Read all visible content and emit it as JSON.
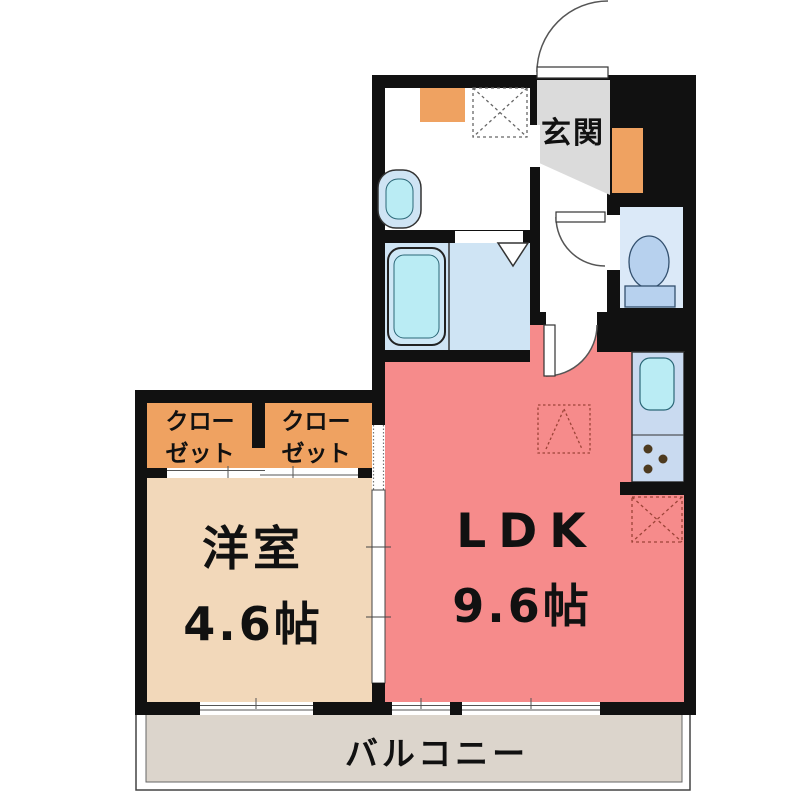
{
  "colors": {
    "wall": "#111111",
    "ldk": "#f68b8b",
    "bedroom": "#f2d8ba",
    "closet": "#efa261",
    "shoe_cabinet": "#efa261",
    "entrance": "#dbdbdb",
    "balcony": "#dcd5cc",
    "bath": "#cfe4f4",
    "toilet_room": "#dbe9f8",
    "kitchen": "#c9daf0",
    "fixture_cyan": "#baecf4",
    "fixture_blue": "#b7d1ee",
    "burner": "#4d3a1f",
    "dashed_outline": "#9c4438"
  },
  "rooms": {
    "ldk": {
      "label": "LDK",
      "size": "9.6帖"
    },
    "bedroom": {
      "label": "洋室",
      "size": "4.6帖"
    },
    "entrance": {
      "label": "玄関"
    },
    "closet_left": {
      "line1": "クロー",
      "line2": "ゼット"
    },
    "closet_right": {
      "line1": "クロー",
      "line2": "ゼット"
    },
    "balcony": {
      "label": "バルコニー"
    }
  }
}
